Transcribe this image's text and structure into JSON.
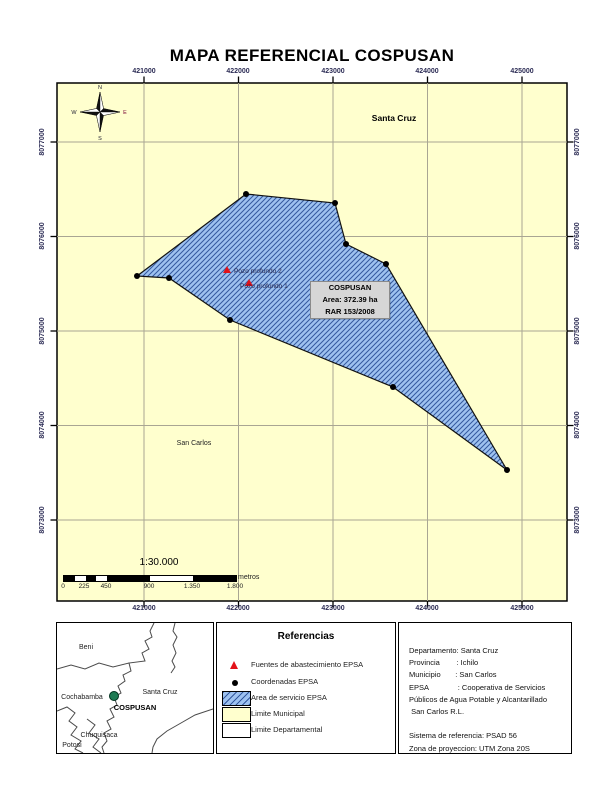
{
  "page": {
    "title": "MAPA REFERENCIAL COSPUSAN"
  },
  "map": {
    "x_ticks": [
      "421000",
      "422000",
      "423000",
      "424000",
      "425000"
    ],
    "y_ticks": [
      "8077000",
      "8076000",
      "8075000",
      "8074000",
      "8073000"
    ],
    "region_labels": {
      "department": "Santa Cruz",
      "municipality": "San Carlos"
    },
    "wells": {
      "well2": "Pozo profundo 2",
      "well1": "Pozo profundo 1"
    },
    "info_box": {
      "name": "COSPUSAN",
      "area": "Area: 372.39 ha",
      "rar": "RAR 153/2008"
    },
    "compass": {
      "n": "N",
      "e": "E",
      "s": "S",
      "w": "W"
    },
    "scale": {
      "ratio": "1:30.000",
      "tick_labels": [
        "0",
        "225",
        "450",
        "900",
        "1.350",
        "1.800"
      ],
      "unit": "metros"
    }
  },
  "locator": {
    "regions": {
      "beni": "Beni",
      "cochabamba": "Cochabamba",
      "santa_cruz": "Santa Cruz",
      "chuquisaca": "Chuquisaca",
      "potosi": "Potosi"
    },
    "marker_label": "COSPUSAN"
  },
  "legend": {
    "title": "Referencias",
    "items": [
      {
        "label": "Fuentes de abastecimiento EPSA"
      },
      {
        "label": "Coordenadas EPSA"
      },
      {
        "label": "Area de servicio EPSA"
      },
      {
        "label": "Limite Municipal"
      },
      {
        "label": "Limite Departamental"
      }
    ]
  },
  "info_panel": {
    "lines": [
      "Departamento: Santa Cruz",
      "Provincia        : Ichilo",
      "Municipio       : San Carlos",
      "EPSA              : Cooperativa de Servicios",
      "Públicos de Agua Potable y Alcantarillado",
      " San Carlos R.L.",
      "",
      "Sistema de referencia: PSAD 56",
      "Zona de proyeccion: UTM Zona 20S"
    ]
  },
  "colors": {
    "map_bg": "#FFFFCE",
    "polygon_fill": "#9EC2F0",
    "hatch": "#33589E",
    "marker_red": "#E31219",
    "locator_marker_green": "#1D7A53",
    "grid": "#A9A693",
    "axis_text": "#2D2D56"
  }
}
